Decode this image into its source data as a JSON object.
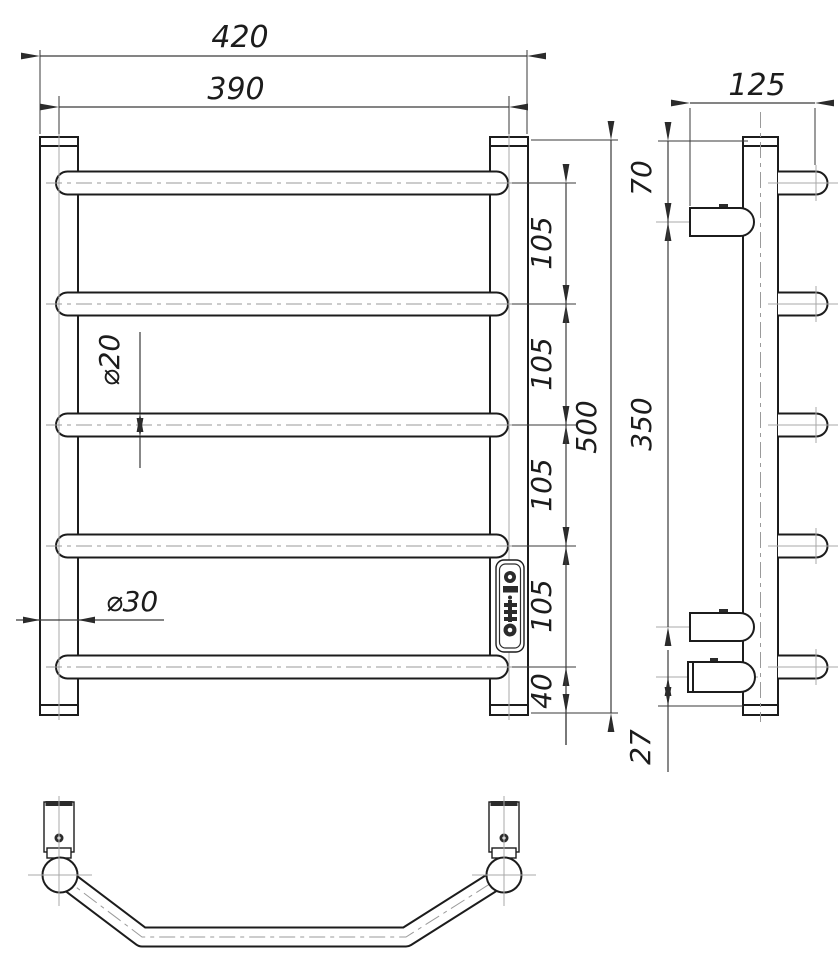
{
  "drawing": {
    "front": {
      "overall_width": "420",
      "centers_width": "390",
      "overall_height": "500",
      "bar_spacings": [
        "105",
        "105",
        "105",
        "105"
      ],
      "bottom_bar_offset": "40",
      "bar_diameter": "⌀20",
      "post_diameter": "⌀30"
    },
    "side": {
      "depth": "125",
      "top_to_bracket": "70",
      "bracket_span": "350",
      "element_offset": "27"
    }
  }
}
